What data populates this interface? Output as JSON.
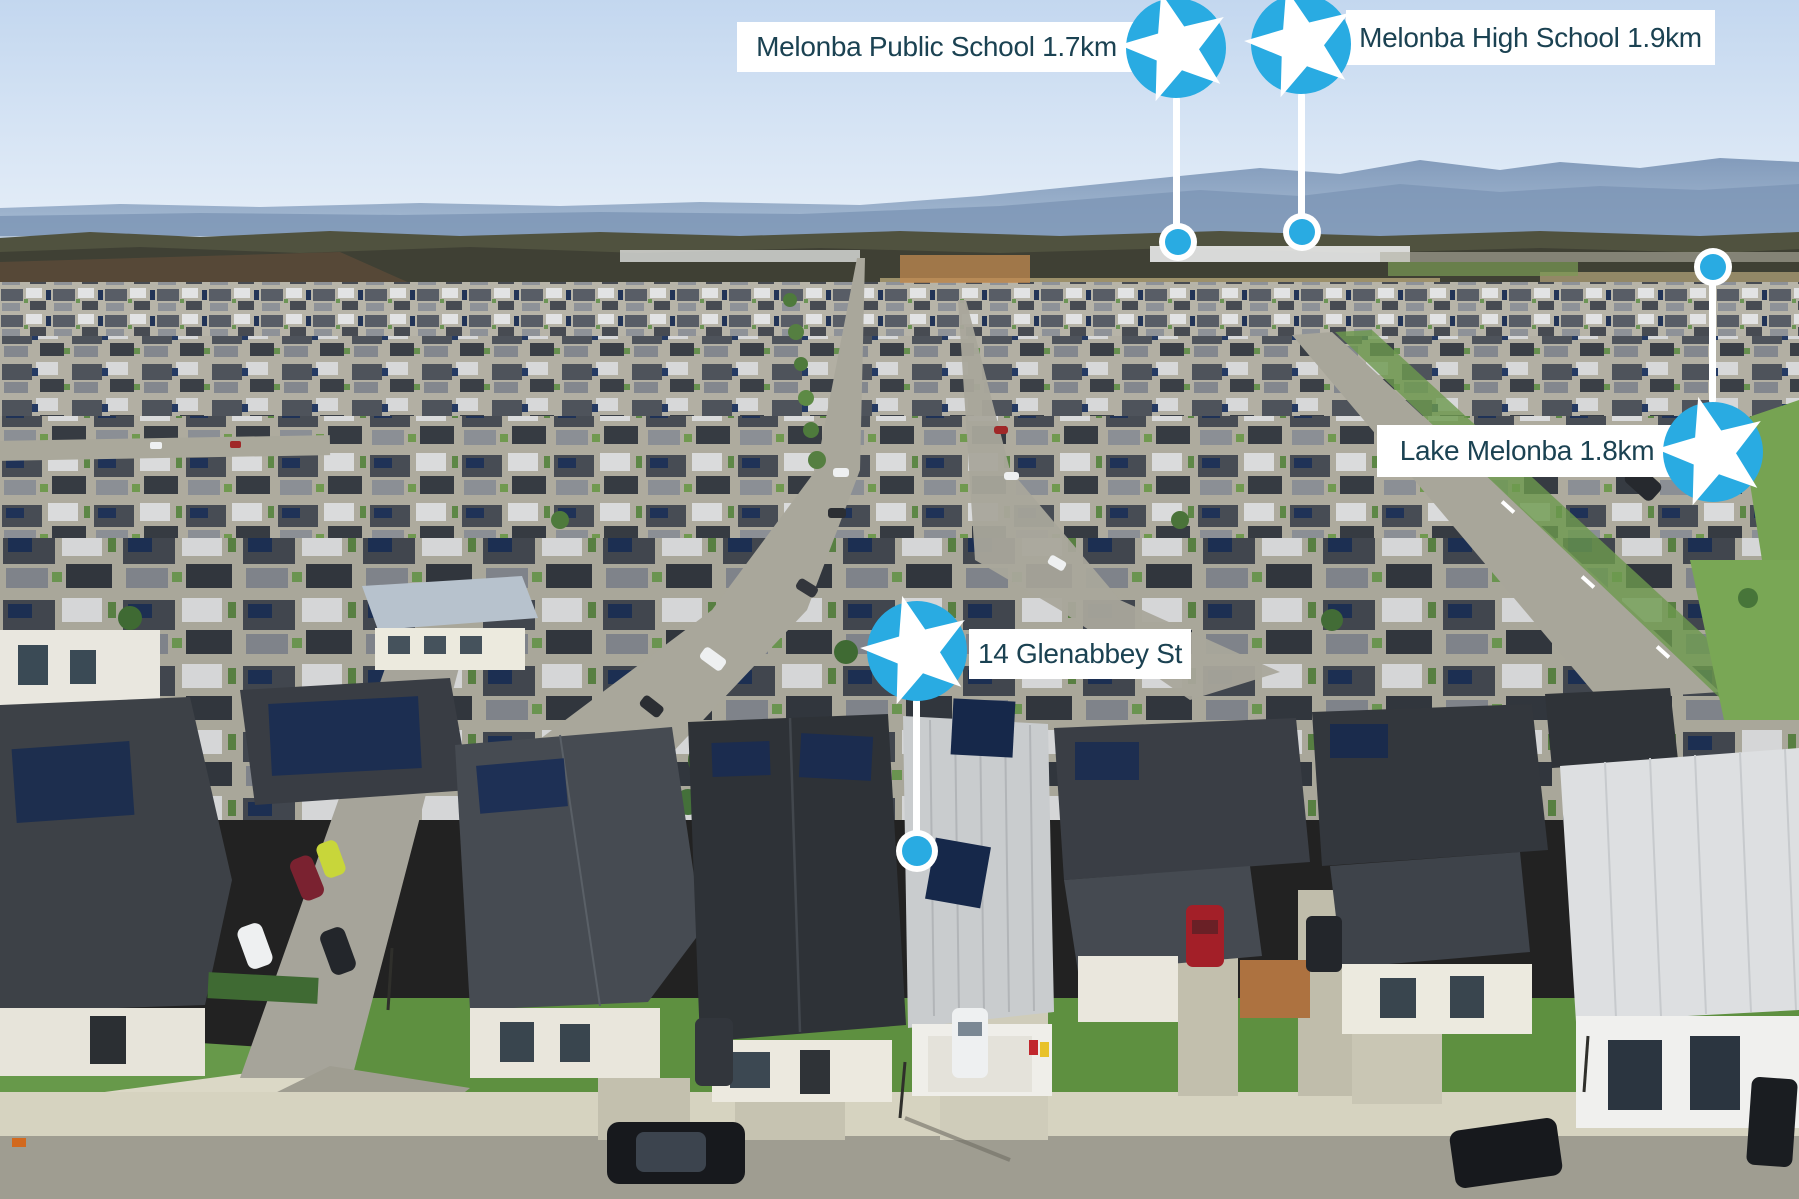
{
  "markers": [
    {
      "id": "melonba-public-school",
      "label": "Melonba Public School 1.7km"
    },
    {
      "id": "melonba-high-school",
      "label": "Melonba High School 1.9km"
    },
    {
      "id": "lake-melonba",
      "label": "Lake Melonba 1.8km"
    },
    {
      "id": "property",
      "label": "14 Glenabbey St"
    }
  ],
  "colors": {
    "marker_blue": "#29ABE2",
    "label_text": "#1B4252",
    "label_background": "#FFFFFF",
    "stem_white": "#FFFFFF"
  }
}
